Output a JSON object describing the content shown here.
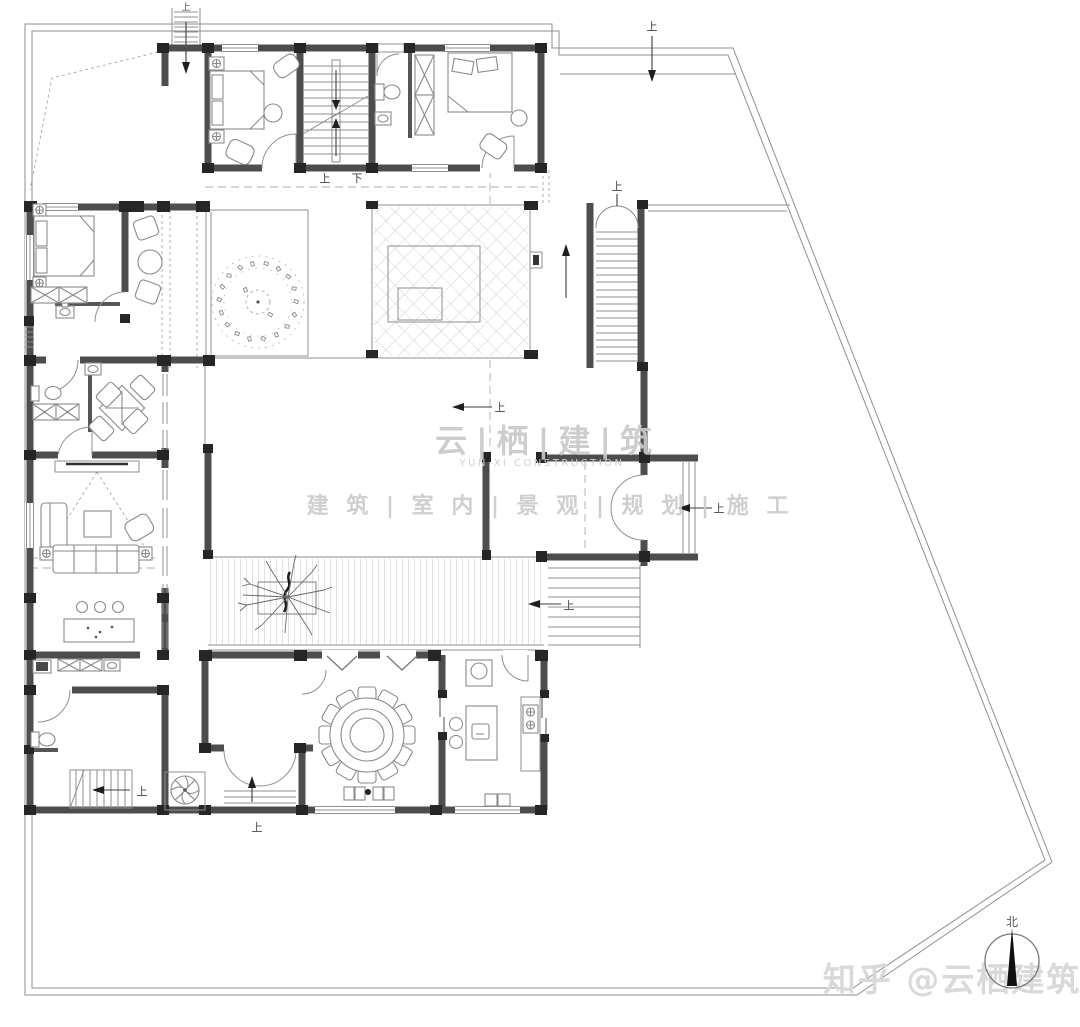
{
  "document": {
    "kind": "residential-floor-plan-drawing",
    "background": "#ffffff"
  },
  "watermark": {
    "brand": "云|栖|建|筑",
    "brand_sub": "YUN XI CONSTRUCTION",
    "services": "建 筑 | 室 内 | 景 观 | 规 划 | 施 工"
  },
  "credit": {
    "text": "知乎 @云栖建筑"
  },
  "compass": {
    "north": "北"
  },
  "labels": {
    "up": "上",
    "down": "下"
  },
  "colors": {
    "wall": "#4d4d4d",
    "column": "#262626",
    "line": "#8f8f8f",
    "watermark": "#cbcbcb",
    "credit": "#d9d9d9",
    "annotation": "#3c3c3c",
    "background": "#ffffff"
  }
}
